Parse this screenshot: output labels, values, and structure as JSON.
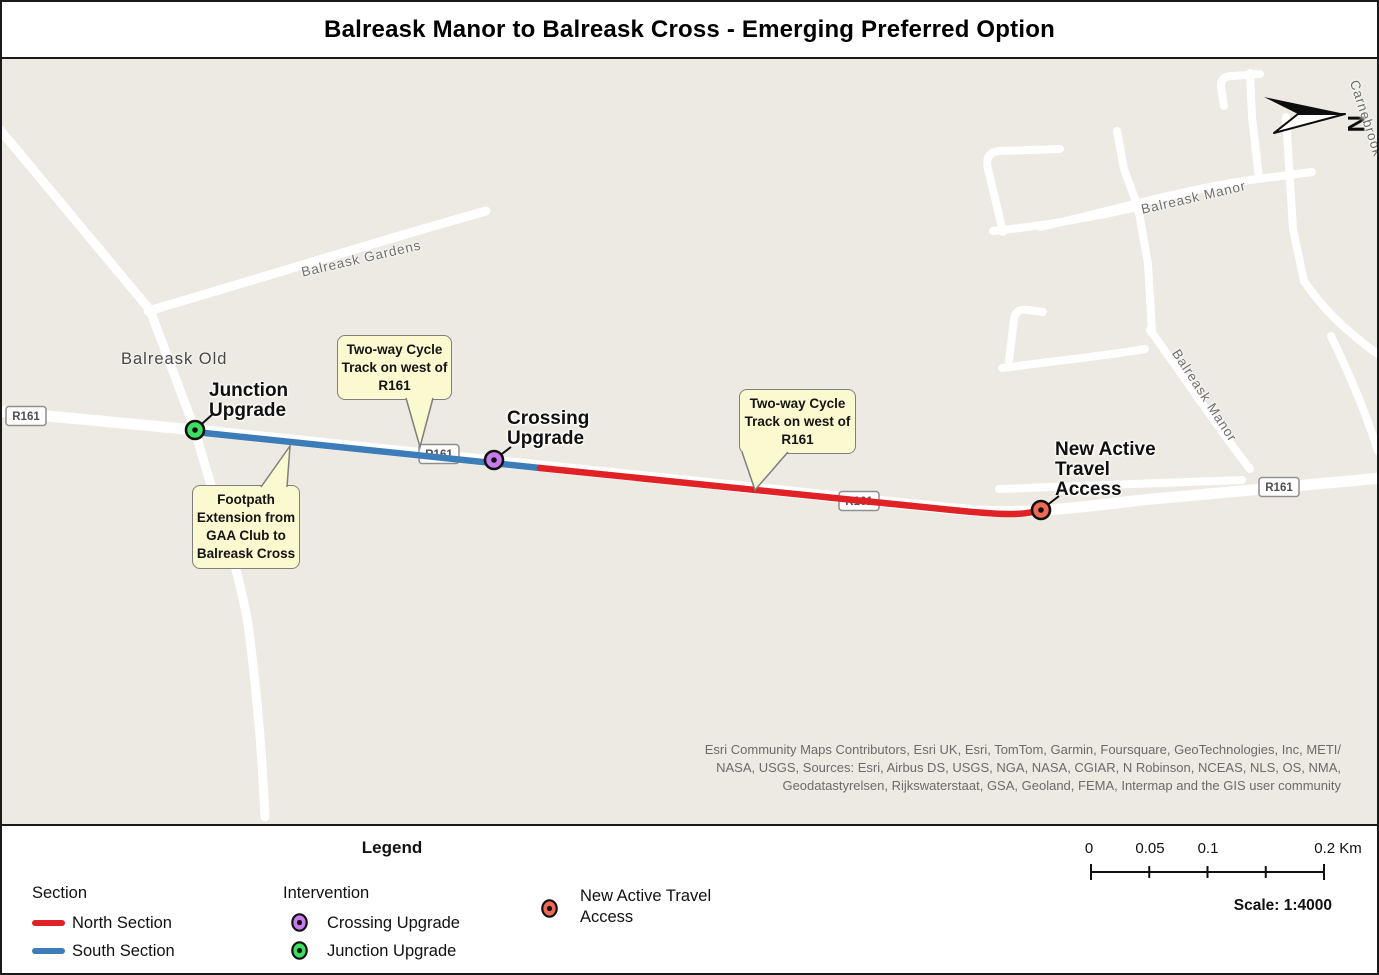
{
  "title": "Balreask Manor to Balreask Cross - Emerging Preferred Option",
  "map": {
    "north": "N",
    "streets": {
      "balreask_gardens": "Balreask Gardens",
      "balreask_old": "Balreask Old",
      "balreask_manor_top": "Balreask Manor",
      "balreask_manor_right": "Balreask Manor",
      "carnebrook": "Carnebrook",
      "shield": "R161"
    },
    "labels": {
      "junction": "Junction\nUpgrade",
      "crossing": "Crossing\nUpgrade",
      "access": "New Active\nTravel\nAccess"
    },
    "callouts": {
      "cycle_track_north": "Two-way Cycle\nTrack on west of\nR161",
      "cycle_track_south": "Two-way Cycle\nTrack on west of\nR161",
      "footpath": "Footpath\nExtension from\nGAA Club to\nBalreask Cross"
    },
    "attribution": "Esri Community Maps Contributors, Esri UK, Esri, TomTom, Garmin, Foursquare, GeoTechnologies, Inc, METI/\nNASA, USGS, Sources: Esri, Airbus DS, USGS, NGA, NASA, CGIAR, N Robinson, NCEAS, NLS, OS, NMA,\nGeodatastyrelsen, Rijkswaterstaat, GSA, Geoland, FEMA, Intermap and the GIS user community"
  },
  "legend": {
    "title": "Legend",
    "section_heading": "Section",
    "north_section": "North Section",
    "south_section": "South Section",
    "intervention_heading": "Intervention",
    "crossing_upgrade": "Crossing Upgrade",
    "junction_upgrade": "Junction Upgrade",
    "access": "New Active Travel\nAccess",
    "scalebar_labels": [
      "0",
      "0.05",
      "0.1",
      "0.2 Km"
    ],
    "scale_text": "Scale: 1:4000"
  },
  "colors": {
    "north_section": "#e02227",
    "south_section": "#3c7cb8",
    "junction_marker": "#3fde60",
    "crossing_marker": "#c77cec",
    "access_marker": "#ee6a57",
    "callout_bg": "#fbf9cf",
    "map_background": "#eceae2",
    "road": "#ffffff"
  }
}
